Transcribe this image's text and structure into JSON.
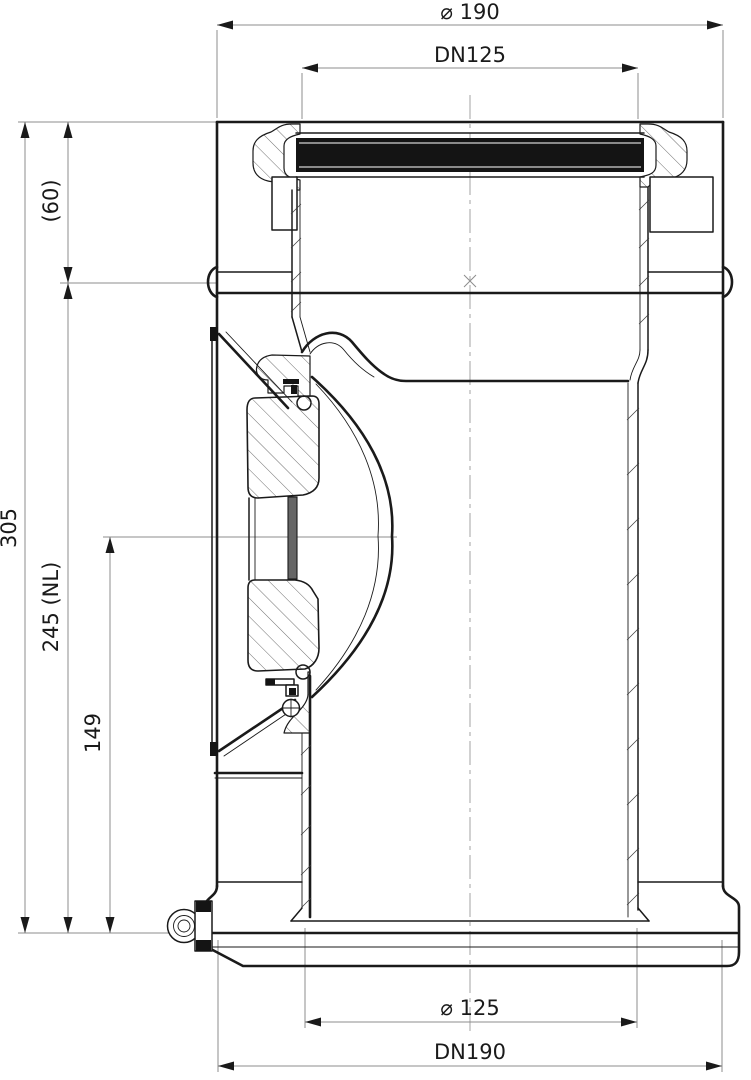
{
  "drawing": {
    "description": "Sectional technical drawing of a double-wall chimney inspection element with access door and condensate drain",
    "colors": {
      "background": "#ffffff",
      "line": "#1a1a1a",
      "dim_line": "#8c8c8c"
    },
    "dims": {
      "outer_diameter_top": "⌀ 190",
      "flue_diameter_top": "DN125",
      "overall_height": "305",
      "socket_depth": "(60)",
      "nominal_length": "245 (NL)",
      "door_axis_height": "149",
      "flue_diameter_bottom": "⌀ 125",
      "outer_diameter_bottom": "DN190"
    }
  }
}
